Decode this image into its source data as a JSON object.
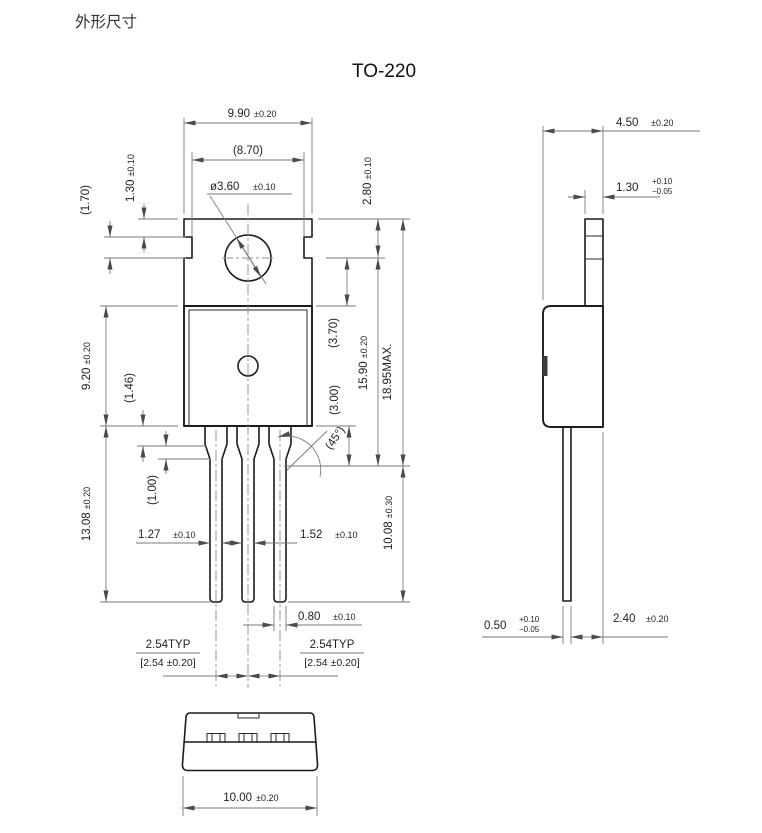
{
  "page": {
    "title": "外形尺寸",
    "package": "TO-220"
  },
  "front": {
    "width": {
      "v": "9.90",
      "t": "±0.20"
    },
    "inner_width": "(8.70)",
    "hole_dia": {
      "v": "ø3.60",
      "t": "±0.10"
    },
    "notch_h": "(1.70)",
    "tab_step": {
      "v": "1.30",
      "t": "±0.10"
    },
    "hole_center": {
      "v": "2.80",
      "t": "±0.10"
    },
    "body_h": {
      "v": "9.20",
      "t": "±0.20"
    },
    "shoulder_h": "(1.46)",
    "hole_to_body": "(3.70)",
    "body_to_chamfer": "(3.00)",
    "mid_h": {
      "v": "15.90",
      "t": "±0.20"
    },
    "total_h": "18.95MAX.",
    "chamfer": "(45°)",
    "lead_l": {
      "v": "13.08",
      "t": "±0.20"
    },
    "taper_h": "(1.00)",
    "lead_w1": {
      "v": "1.27",
      "t": "±0.10"
    },
    "lead_w2": {
      "v": "1.52",
      "t": "±0.10"
    },
    "lead_tip_w": {
      "v": "0.80",
      "t": "±0.10"
    },
    "lead_exposed": {
      "v": "10.08",
      "t": "±0.30"
    },
    "pitch_left": {
      "l1": "2.54TYP",
      "l2": "[2.54 ±0.20]"
    },
    "pitch_right": {
      "l1": "2.54TYP",
      "l2": "[2.54 ±0.20]"
    }
  },
  "side": {
    "depth": {
      "v": "4.50",
      "t": "±0.20"
    },
    "tab_t": {
      "v": "1.30",
      "tp": "+0.10",
      "tm": "−0.05"
    },
    "lead_t": {
      "v": "0.50",
      "tp": "+0.10",
      "tm": "−0.05"
    },
    "offset": {
      "v": "2.40",
      "t": "±0.20"
    }
  },
  "bottom": {
    "width": {
      "v": "10.00",
      "t": "±0.20"
    }
  },
  "colors": {
    "line": "#1c1c1c",
    "dim": "#7a7a7a",
    "text": "#222222"
  }
}
